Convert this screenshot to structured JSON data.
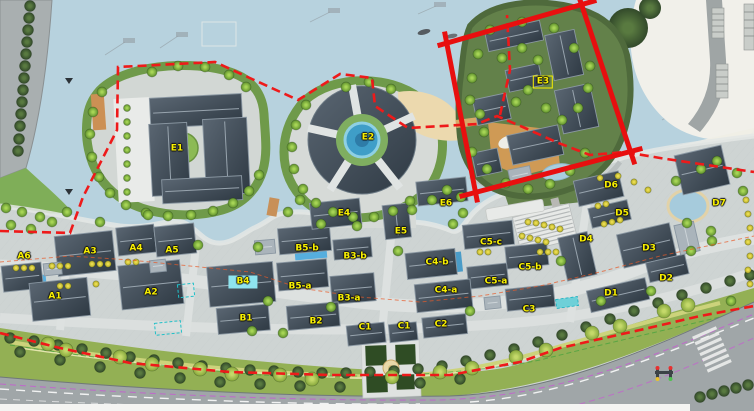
{
  "map": {
    "kind": "site-master-plan",
    "highlight": {
      "shape": "rectangle",
      "around": "E3"
    }
  },
  "colors": {
    "annotation_red": "#e80f0f",
    "boundary_dash_red": "#ee1a1a",
    "label_yellow": "#f8f000",
    "highlight_cyan": "#8fe4ef",
    "water_blue": "#b7d2de",
    "road_gray": "#a0a6a8",
    "buffer_green": "#93b054",
    "lane_magenta": "#c45fd0"
  },
  "labels": {
    "buildings": [
      {
        "key": "E1",
        "id": "E1",
        "x": 177,
        "y": 149
      },
      {
        "key": "E2",
        "id": "E2",
        "x": 368,
        "y": 138
      },
      {
        "key": "E3",
        "id": "E3",
        "x": 543,
        "y": 82,
        "boxed": true
      },
      {
        "key": "E4",
        "id": "E4",
        "x": 344,
        "y": 214
      },
      {
        "key": "E5",
        "id": "E5",
        "x": 401,
        "y": 232
      },
      {
        "key": "E6",
        "id": "E6",
        "x": 446,
        "y": 204
      },
      {
        "key": "A6",
        "id": "A6",
        "x": 24,
        "y": 257
      },
      {
        "key": "A3",
        "id": "A3",
        "x": 90,
        "y": 252
      },
      {
        "key": "A4",
        "id": "A4",
        "x": 136,
        "y": 249
      },
      {
        "key": "A5",
        "id": "A5",
        "x": 172,
        "y": 251
      },
      {
        "key": "A1",
        "id": "A1",
        "x": 55,
        "y": 297
      },
      {
        "key": "A2",
        "id": "A2",
        "x": 151,
        "y": 293
      },
      {
        "key": "B5-b",
        "id": "B5-b",
        "x": 307,
        "y": 249
      },
      {
        "key": "B3-b",
        "id": "B3-b",
        "x": 355,
        "y": 257
      },
      {
        "key": "B4",
        "id": "B4",
        "x": 243,
        "y": 282,
        "highlight": "cyan"
      },
      {
        "key": "B5-a",
        "id": "B5-a",
        "x": 300,
        "y": 287
      },
      {
        "key": "B3-a",
        "id": "B3-a",
        "x": 349,
        "y": 299
      },
      {
        "key": "B1",
        "id": "B1",
        "x": 246,
        "y": 319
      },
      {
        "key": "B2",
        "id": "B2",
        "x": 316,
        "y": 322
      },
      {
        "key": "C1-1",
        "id": "C1",
        "x": 365,
        "y": 328
      },
      {
        "key": "C1-2",
        "id": "C1",
        "x": 404,
        "y": 327
      },
      {
        "key": "C2",
        "id": "C2",
        "x": 441,
        "y": 325
      },
      {
        "key": "C4-b",
        "id": "C4-b",
        "x": 437,
        "y": 263
      },
      {
        "key": "C5-c",
        "id": "C5-c",
        "x": 491,
        "y": 243
      },
      {
        "key": "C5-b",
        "id": "C5-b",
        "x": 530,
        "y": 268
      },
      {
        "key": "C5-a",
        "id": "C5-a",
        "x": 496,
        "y": 282
      },
      {
        "key": "C4-a",
        "id": "C4-a",
        "x": 446,
        "y": 291
      },
      {
        "key": "C3",
        "id": "C3",
        "x": 529,
        "y": 310
      },
      {
        "key": "D6",
        "id": "D6",
        "x": 611,
        "y": 186
      },
      {
        "key": "D5",
        "id": "D5",
        "x": 622,
        "y": 214
      },
      {
        "key": "D4",
        "id": "D4",
        "x": 586,
        "y": 240
      },
      {
        "key": "D3",
        "id": "D3",
        "x": 649,
        "y": 249
      },
      {
        "key": "D2",
        "id": "D2",
        "x": 666,
        "y": 279
      },
      {
        "key": "D1",
        "id": "D1",
        "x": 611,
        "y": 294
      },
      {
        "key": "D7",
        "id": "D7",
        "x": 719,
        "y": 204
      }
    ]
  }
}
